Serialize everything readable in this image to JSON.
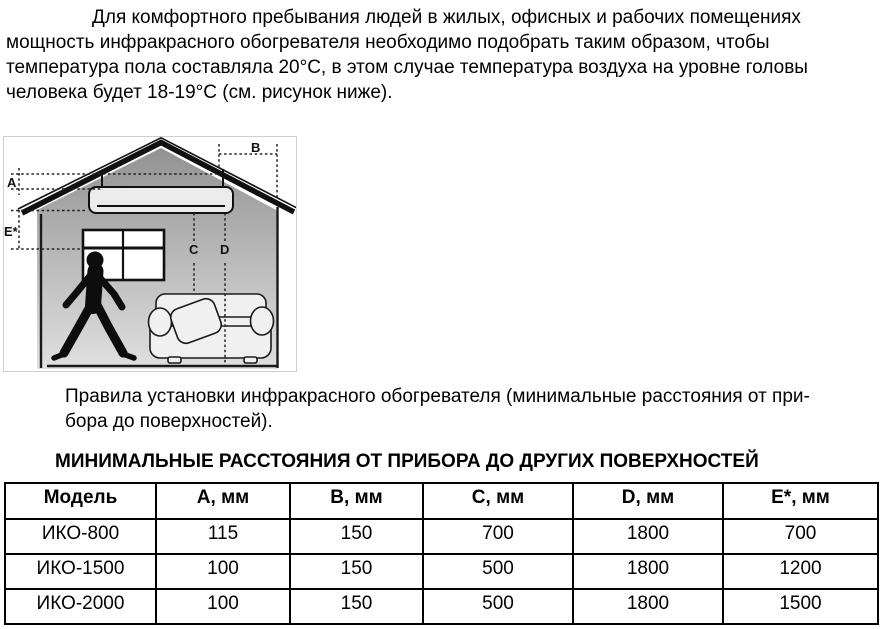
{
  "intro_paragraph": {
    "lines": [
      "Для комфортного пребывания людей в жилых, офисных и рабочих помещениях",
      "мощность инфракрасного обогревателя необходимо подобрать таким образом, чтобы",
      "температура пола составляла 20°C, в этом случае температура воздуха на уровне головы",
      "человека будет 18-19°C (см. рисунок ниже)."
    ]
  },
  "figure": {
    "labels": {
      "a": "A",
      "b": "B",
      "c": "C",
      "d": "D",
      "e": "E*"
    }
  },
  "caption": {
    "lines": [
      "Правила установки инфракрасного обогревателя (минимальные расстояния от при-",
      "бора до поверхностей)."
    ]
  },
  "distance_table": {
    "title": "МИНИМАЛЬНЫЕ РАССТОЯНИЯ ОТ ПРИБОРА ДО ДРУГИХ ПОВЕРХНОСТЕЙ",
    "columns": [
      "Модель",
      "A, мм",
      "B, мм",
      "C, мм",
      "D, мм",
      "E*, мм"
    ],
    "rows": [
      [
        "ИКО-800",
        "115",
        "150",
        "700",
        "1800",
        "700"
      ],
      [
        "ИКО-1500",
        "100",
        "150",
        "500",
        "1800",
        "1200"
      ],
      [
        "ИКО-2000",
        "100",
        "150",
        "500",
        "1800",
        "1500"
      ]
    ]
  }
}
